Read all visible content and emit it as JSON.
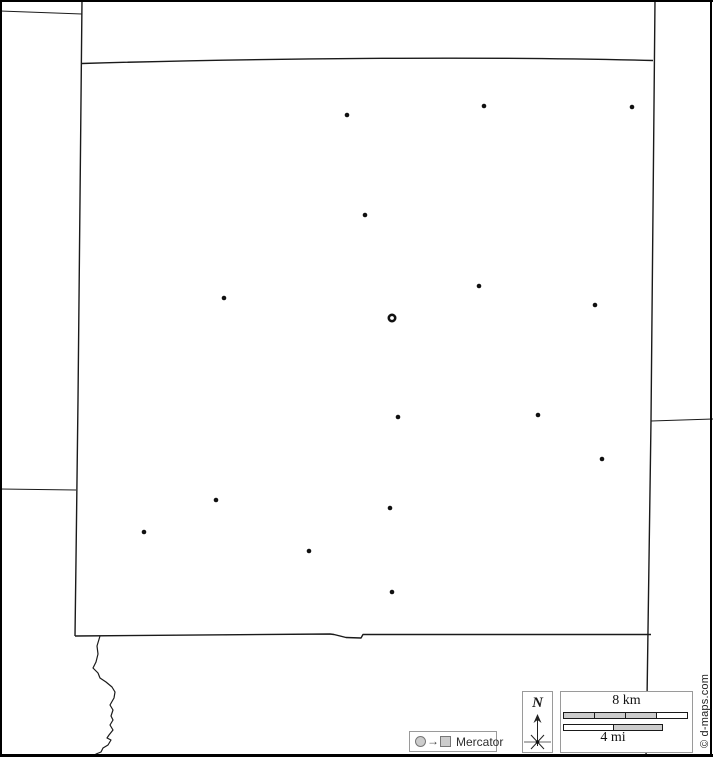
{
  "colors": {
    "border_line": "#1a1a1a",
    "frame": "#000000",
    "legend_border": "#9a9a9a",
    "bar_fill": "#cccccc",
    "marker": "#111111"
  },
  "map": {
    "paths": [
      {
        "name": "west-boundary-line",
        "d": "M82,0 L80,200 L78,400 L76,560 L75,636",
        "width": 1.4
      },
      {
        "name": "northwest-neighbor-line",
        "d": "M0,11 L82,14",
        "width": 1.1
      },
      {
        "name": "west-neighbor-line",
        "d": "M0,489 L76,490",
        "width": 1.1
      },
      {
        "name": "county-north-border",
        "d": "M82,63.5 C250,58.5 480,56 653,60.5",
        "width": 1.4
      },
      {
        "name": "east-boundary-line",
        "d": "M655,0 L651,421 L647,700 L646,757",
        "width": 1.4
      },
      {
        "name": "east-neighbor-line",
        "d": "M651,421 L713,419",
        "width": 1.1
      },
      {
        "name": "county-south-border",
        "d": "M75,636 L330,634 L334,634.5 L346,637.5 L361,638 L363,634.5 L651,634.5",
        "width": 1.4
      },
      {
        "name": "river",
        "d": "M100,636 L97,646 L98,654 L96,662 L93,668 L98,673 L100,678 L106,682 L112,687 L115,692 L114,698 L110,705 L113,710 L111,716 L113,720 L110,725 L113,730 L109,735 L107,738 L111,740 L108,745 L103,748 L101,752 L96,754 L94,756",
        "width": 1.2
      }
    ],
    "markers": [
      {
        "x": 347,
        "y": 115,
        "type": "town"
      },
      {
        "x": 484,
        "y": 106,
        "type": "town"
      },
      {
        "x": 632,
        "y": 107,
        "type": "town"
      },
      {
        "x": 365,
        "y": 215,
        "type": "town"
      },
      {
        "x": 224,
        "y": 298,
        "type": "town"
      },
      {
        "x": 479,
        "y": 286,
        "type": "town"
      },
      {
        "x": 595,
        "y": 305,
        "type": "town"
      },
      {
        "x": 392,
        "y": 318,
        "type": "seat"
      },
      {
        "x": 398,
        "y": 417,
        "type": "town"
      },
      {
        "x": 538,
        "y": 415,
        "type": "town"
      },
      {
        "x": 602,
        "y": 459,
        "type": "town"
      },
      {
        "x": 216,
        "y": 500,
        "type": "town"
      },
      {
        "x": 390,
        "y": 508,
        "type": "town"
      },
      {
        "x": 144,
        "y": 532,
        "type": "town"
      },
      {
        "x": 309,
        "y": 551,
        "type": "town"
      },
      {
        "x": 392,
        "y": 592,
        "type": "town"
      }
    ]
  },
  "legend": {
    "projection": {
      "label": "Mercator",
      "arrow_glyph": "→"
    },
    "compass": {
      "label": "N"
    },
    "scale": {
      "km_label": "8 km",
      "mi_label": "4 mi",
      "km_segments": [
        "#cccccc",
        "#cccccc",
        "#cccccc",
        "#ffffff"
      ],
      "mi_segments": [
        "#ffffff",
        "#cccccc"
      ]
    }
  },
  "attribution": {
    "label": "© d-maps.com"
  }
}
